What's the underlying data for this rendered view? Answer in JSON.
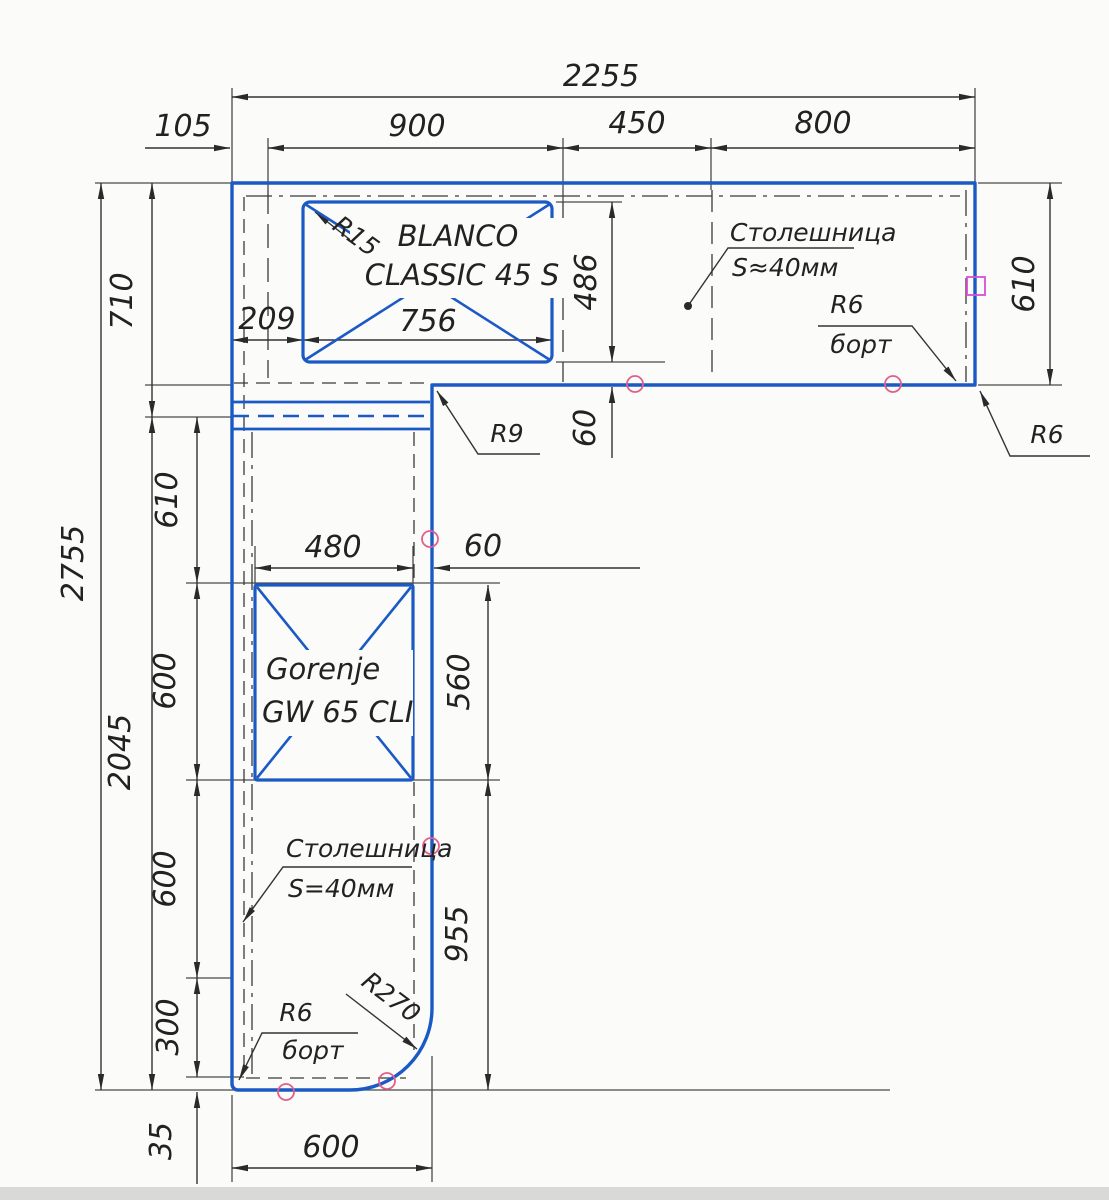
{
  "dims": {
    "top_overall": "2255",
    "top_offset": "105",
    "top_seg_900": "900",
    "top_seg_450": "450",
    "top_seg_800": "800",
    "left_overall": "2755",
    "left_upper": "710",
    "left_lower": "2045",
    "left_610": "610",
    "left_600a": "600",
    "left_600b": "600",
    "left_300": "300",
    "left_35": "35",
    "right_depth": "610",
    "bottom_leg_width": "600",
    "sink_offset": "209",
    "sink_width": "756",
    "sink_depth": "486",
    "sink_front_gap": "60",
    "cooktop_width": "480",
    "cooktop_side_gap": "60",
    "cooktop_depth": "560",
    "leg_front_length": "955"
  },
  "annotations": {
    "sink_corner_radius": "R15",
    "inner_corner_radius": "R9",
    "edge_radius_top": "R6",
    "edge_label_top": "борт",
    "corner_radius_right": "R6",
    "worktop_note_top_line1": "Столешница",
    "worktop_note_top_line2": "S≈40мм",
    "worktop_note_bottom_line1": "Столешница",
    "worktop_note_bottom_line2": "S=40мм",
    "edge_radius_bottom": "R6",
    "edge_label_bottom": "борт",
    "leg_corner_radius": "R270"
  },
  "appliances": {
    "sink": {
      "brand": "BLANCO",
      "model": "CLASSIC 45 S"
    },
    "cooktop": {
      "brand": "Gorenje",
      "model": "GW 65 CLI"
    }
  },
  "colors": {
    "outline_blue": "#1b59c5",
    "dimension_black": "#3a3a3a",
    "check_pink": "#e25f8a",
    "marker_magenta": "#d84fd8"
  }
}
